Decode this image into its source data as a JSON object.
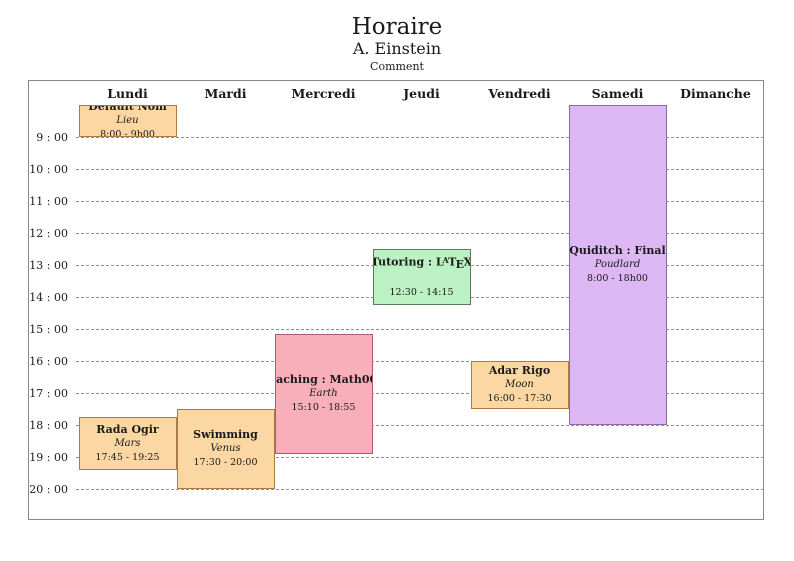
{
  "page": {
    "title": "Horaire",
    "author": "A. Einstein",
    "comment": "Comment"
  },
  "calendar": {
    "days": [
      "Lundi",
      "Mardi",
      "Mercredi",
      "Jeudi",
      "Vendredi",
      "Samedi",
      "Dimanche"
    ],
    "hour_labels": [
      "9 : 00",
      "10 : 00",
      "11 : 00",
      "12 : 00",
      "13 : 00",
      "14 : 00",
      "15 : 00",
      "16 : 00",
      "17 : 00",
      "18 : 00",
      "19 : 00",
      "20 : 00"
    ],
    "first_labeled_hour": 9,
    "last_labeled_hour": 20,
    "grid_top_hour": 8
  },
  "palette": {
    "orange": {
      "fill": "#fbd7a4",
      "border": "#a97c44"
    },
    "red": {
      "fill": "#f9afba",
      "border": "#a85f66"
    },
    "green": {
      "fill": "#bcf2c3",
      "border": "#5c7a5c"
    },
    "violet": {
      "fill": "#dcb7f4",
      "border": "#8f68a8"
    },
    "frame_border": "#8a8a8a",
    "gridline": "#8f8f8f"
  },
  "events": [
    {
      "name": "default-nom",
      "title": "Default Nom",
      "location": "Lieu",
      "time_label": "8:00 - 9h00",
      "day": "Lundi",
      "day_index": 0,
      "start": 8.0,
      "end": 9.0,
      "color": "orange"
    },
    {
      "name": "tutoring-latex",
      "title": "Tutoring : LaTeX",
      "location": "",
      "time_label": "12:30 - 14:15",
      "day": "Jeudi",
      "day_index": 3,
      "start": 12.5,
      "end": 14.25,
      "color": "green"
    },
    {
      "name": "quiditch-final",
      "title": "Quiditch : Final",
      "location": "Poudlard",
      "time_label": "8:00 - 18h00",
      "day": "Samedi",
      "day_index": 5,
      "start": 8.0,
      "end": 18.0,
      "color": "violet"
    },
    {
      "name": "teaching-math007",
      "title": "Teaching : Math007",
      "location": "Earth",
      "time_label": "15:10 - 18:55",
      "day": "Mercredi",
      "day_index": 2,
      "start": 15.167,
      "end": 18.917,
      "color": "red"
    },
    {
      "name": "adar-rigo",
      "title": "Adar Rigo",
      "location": "Moon",
      "time_label": "16:00 - 17:30",
      "day": "Vendredi",
      "day_index": 4,
      "start": 16.0,
      "end": 17.5,
      "color": "orange"
    },
    {
      "name": "rada-ogir",
      "title": "Rada Ogir",
      "location": "Mars",
      "time_label": "17:45 - 19:25",
      "day": "Lundi",
      "day_index": 0,
      "start": 17.75,
      "end": 19.417,
      "color": "orange"
    },
    {
      "name": "swimming",
      "title": "Swimming",
      "location": "Venus",
      "time_label": "17:30 - 20:00",
      "day": "Mardi",
      "day_index": 1,
      "start": 17.5,
      "end": 20.0,
      "color": "orange"
    }
  ]
}
